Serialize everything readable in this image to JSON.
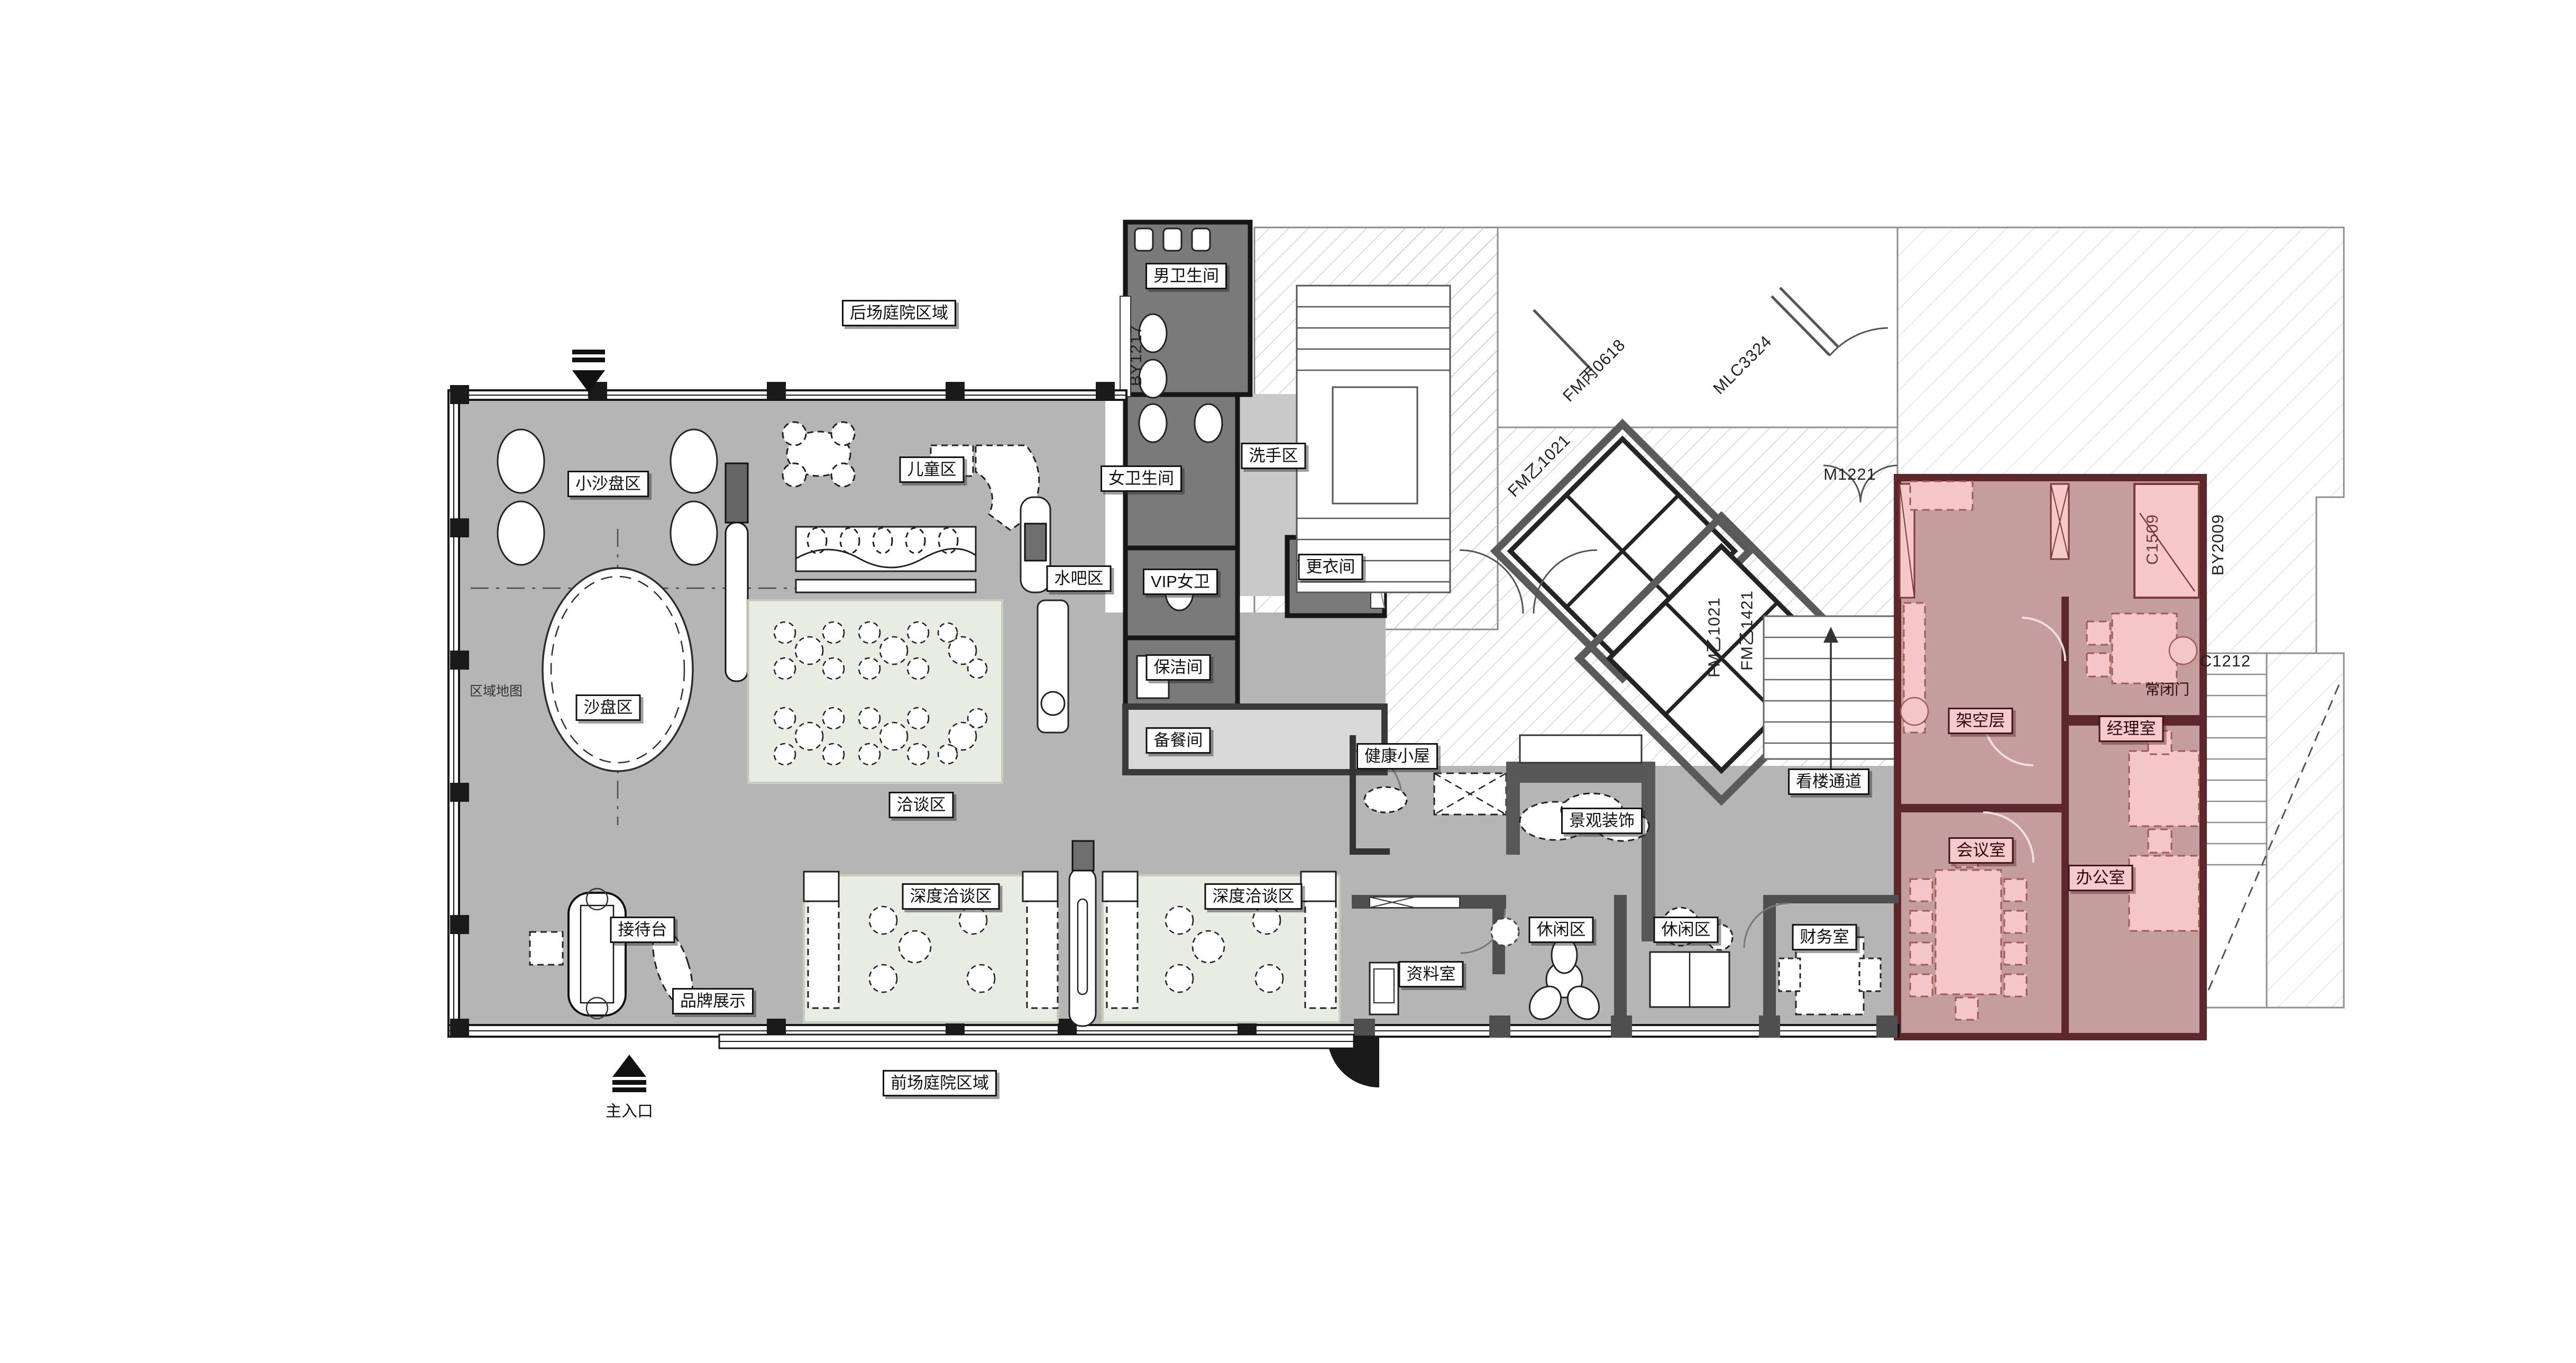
{
  "drawing": {
    "type": "interior-floor-plan",
    "highlight_zone": "office wing (architectural pink overlay)"
  },
  "colors": {
    "floor_gray": "#b5b5b5",
    "dark_room_gray": "#7a7a7a",
    "light_gray_floor": "#c9c9c9",
    "pink_floor": "#c69d9d",
    "pink_wall": "#5d282a",
    "pink_furniture": "#f5c6c6",
    "rug_green": "#e9ece3",
    "wall_black": "#161616",
    "hatch_line": "#b3b3b3"
  },
  "labels": [
    {
      "id": "back-courtyard",
      "text": "后场庭院区域"
    },
    {
      "id": "mens-restroom",
      "text": "男卫生间"
    },
    {
      "id": "womens-restroom",
      "text": "女卫生间"
    },
    {
      "id": "handwash-area",
      "text": "洗手区"
    },
    {
      "id": "small-sandtable-area",
      "text": "小沙盘区"
    },
    {
      "id": "kids-area",
      "text": "儿童区"
    },
    {
      "id": "water-bar-area",
      "text": "水吧区"
    },
    {
      "id": "vip-womens-wc",
      "text": "VIP女卫"
    },
    {
      "id": "changing-room",
      "text": "更衣间"
    },
    {
      "id": "sandtable-area",
      "text": "沙盘区"
    },
    {
      "id": "cleaning-room",
      "text": "保洁间"
    },
    {
      "id": "pantry",
      "text": "备餐间"
    },
    {
      "id": "negotiation-area",
      "text": "洽谈区"
    },
    {
      "id": "health-cabin",
      "text": "健康小屋"
    },
    {
      "id": "landscape-decor",
      "text": "景观装饰"
    },
    {
      "id": "viewing-corridor",
      "text": "看楼通道"
    },
    {
      "id": "stilt-floor",
      "text": "架空层"
    },
    {
      "id": "manager-room",
      "text": "经理室"
    },
    {
      "id": "meeting-room",
      "text": "会议室"
    },
    {
      "id": "office-room",
      "text": "办公室"
    },
    {
      "id": "reception-desk",
      "text": "接待台"
    },
    {
      "id": "brand-display",
      "text": "品牌展示"
    },
    {
      "id": "deep-negotiation-1",
      "text": "深度洽谈区"
    },
    {
      "id": "deep-negotiation-2",
      "text": "深度洽谈区"
    },
    {
      "id": "archives-room",
      "text": "资料室"
    },
    {
      "id": "leisure-1",
      "text": "休闲区"
    },
    {
      "id": "leisure-2",
      "text": "休闲区"
    },
    {
      "id": "finance-room",
      "text": "财务室"
    },
    {
      "id": "front-courtyard",
      "text": "前场庭院区域"
    },
    {
      "id": "normally-closed-door",
      "text": "常闭门"
    },
    {
      "id": "main-entrance",
      "text": "主入口"
    },
    {
      "id": "area-map",
      "text": "区域地图"
    },
    {
      "id": "code-by1217",
      "text": "BY1217"
    },
    {
      "id": "code-m1221",
      "text": "M1221"
    },
    {
      "id": "code-mlc3324",
      "text": "MLC3324"
    },
    {
      "id": "code-fm-bing-0618",
      "text": "FM丙0618"
    },
    {
      "id": "code-fm-yi-1021-a",
      "text": "FM乙1021"
    },
    {
      "id": "code-fm-yi-1021-b",
      "text": "FM乙1021"
    },
    {
      "id": "code-fm-yi-1421",
      "text": "FM乙1421"
    },
    {
      "id": "code-c1509",
      "text": "C1509"
    },
    {
      "id": "code-by2009",
      "text": "BY2009"
    },
    {
      "id": "code-c1212",
      "text": "C1212"
    }
  ]
}
